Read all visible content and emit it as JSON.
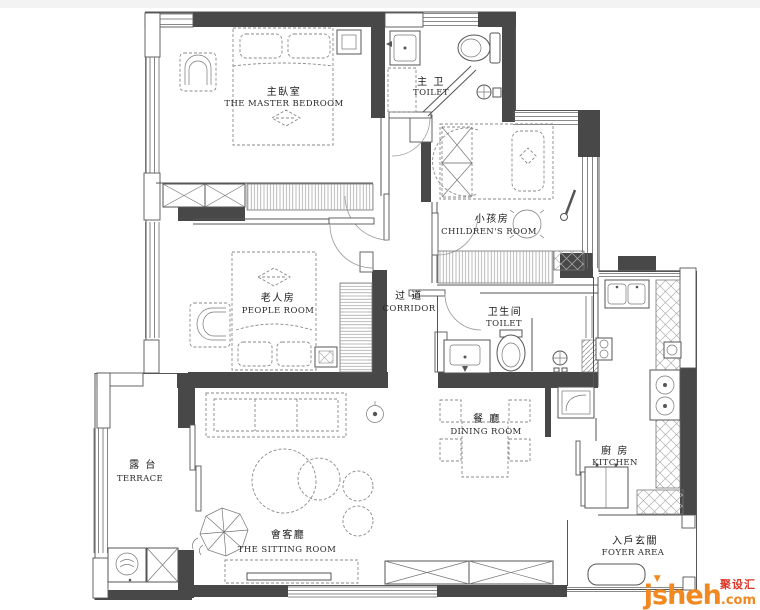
{
  "title": "apartment-floor-plan",
  "colors": {
    "wall": "#484848",
    "line": "#555555",
    "furniture": "#8a8a8a",
    "logo_orange": "#F28820",
    "logo_red": "#DD3526"
  },
  "rooms": {
    "master_bedroom": {
      "cn": "主臥室",
      "en": "THE MASTER BEDROOM"
    },
    "master_bath": {
      "cn": "主 卫",
      "en": "TOILET"
    },
    "children": {
      "cn": "小孩房",
      "en": "CHILDREN'S ROOM"
    },
    "people": {
      "cn": "老人房",
      "en": "PEOPLE ROOM"
    },
    "corridor": {
      "cn": "过 道",
      "en": "CORRIDOR"
    },
    "toilet": {
      "cn": "卫生间",
      "en": "TOILET"
    },
    "dining": {
      "cn": "餐 廳",
      "en": "DINING ROOM"
    },
    "kitchen": {
      "cn": "廚 房",
      "en": "KITCHEN"
    },
    "sitting": {
      "cn": "會客廳",
      "en": "THE SITTING ROOM"
    },
    "terrace": {
      "cn": "露 台",
      "en": "TERRACE"
    },
    "foyer": {
      "cn": "入戶玄關",
      "en": "FOYER AREA"
    }
  },
  "logo": {
    "name": "jsheh",
    "tld": ".com",
    "cn": "聚设汇"
  }
}
